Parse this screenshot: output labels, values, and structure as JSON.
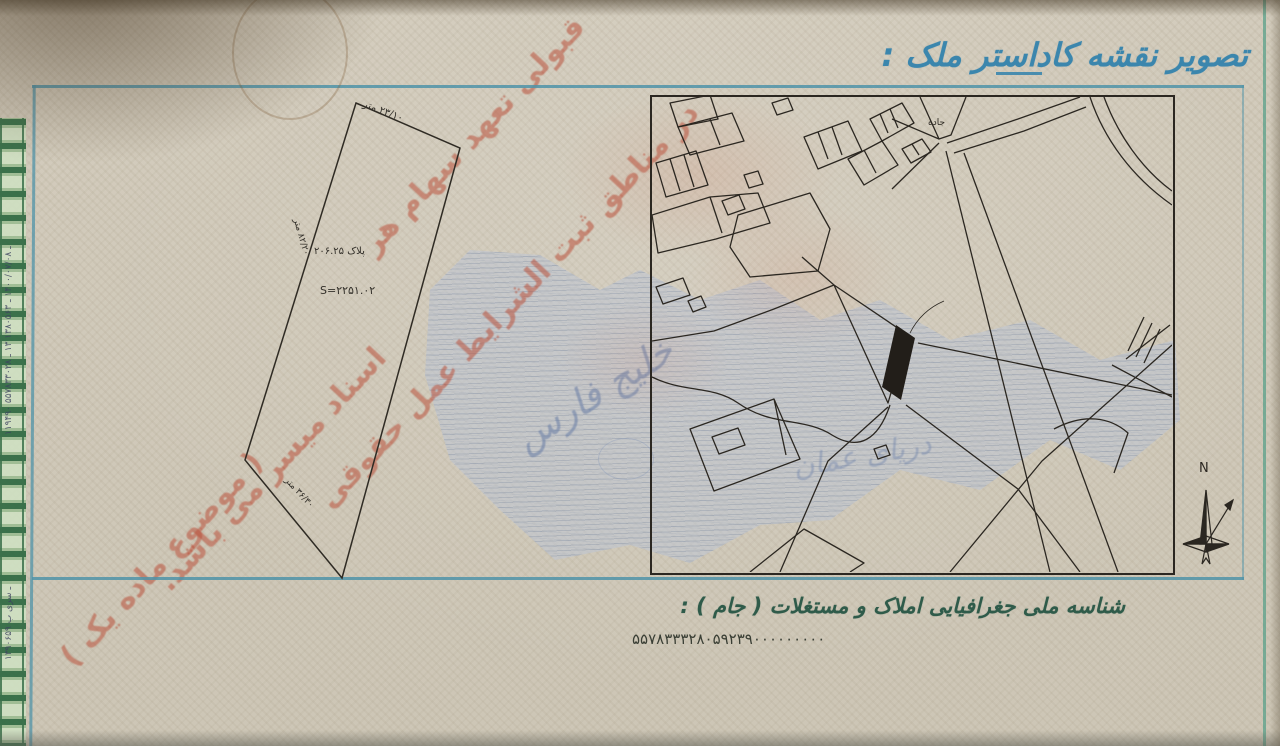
{
  "header": {
    "title": "تصویر نقشه کاداستر ملک :"
  },
  "plot_diagram": {
    "plate_label": "پلاک ۲۰۶.۲۵",
    "area_label": "S=۲۲۵۱.۰۲",
    "edge_top_length": "۲۳/۱۰ متر",
    "edge_left_length": "۸۲/۲۰ متر",
    "edge_bottom_length": "۳۶/۳۰ متر"
  },
  "map": {
    "road_label": "جاده",
    "compass_north_label": "N",
    "watermark_sea_1": "خلیج فارس",
    "watermark_sea_2": "دریای عمان"
  },
  "stamp_overprint": {
    "line_1": "قبولی تعهد سهام هر",
    "line_2": "در مناطق ثبت الشرایط عمل حقوقی",
    "line_3": "اسناد میسر می باشد.",
    "line_4": "( موضوع ماده یک )"
  },
  "margin_print": {
    "serial_upper": "۱۱۹۴۹۰ ـ ۱۴۰۰/۰۷/۰۸ ـ ۱۳۸۰۵۶۳ ۱۳ ـ ۵۵۷۸۳۳۰۲۸",
    "serial_lower": "۱۳۹۰۶۵۹ ـ سری ب"
  },
  "footer": {
    "jam_label": "شناسه ملی جغرافیایی املاک و مستغلات ( جام ) :",
    "jam_number": "۵۵۷۸۳۳۳۲۸۰۵۹۲۳۹۰۰۰۰۰۰۰۰۰"
  },
  "colors": {
    "title_blue": "#3b86ad",
    "frame_blue": "#4f93a8",
    "footer_green": "#2f5b4a",
    "stamp_red": "#b8503a",
    "map_ink": "#2b2721",
    "sea_watermark_blue": "#7d8ca5",
    "border_green": "#2f6a42",
    "paper_beige": "#d0c9ba"
  }
}
